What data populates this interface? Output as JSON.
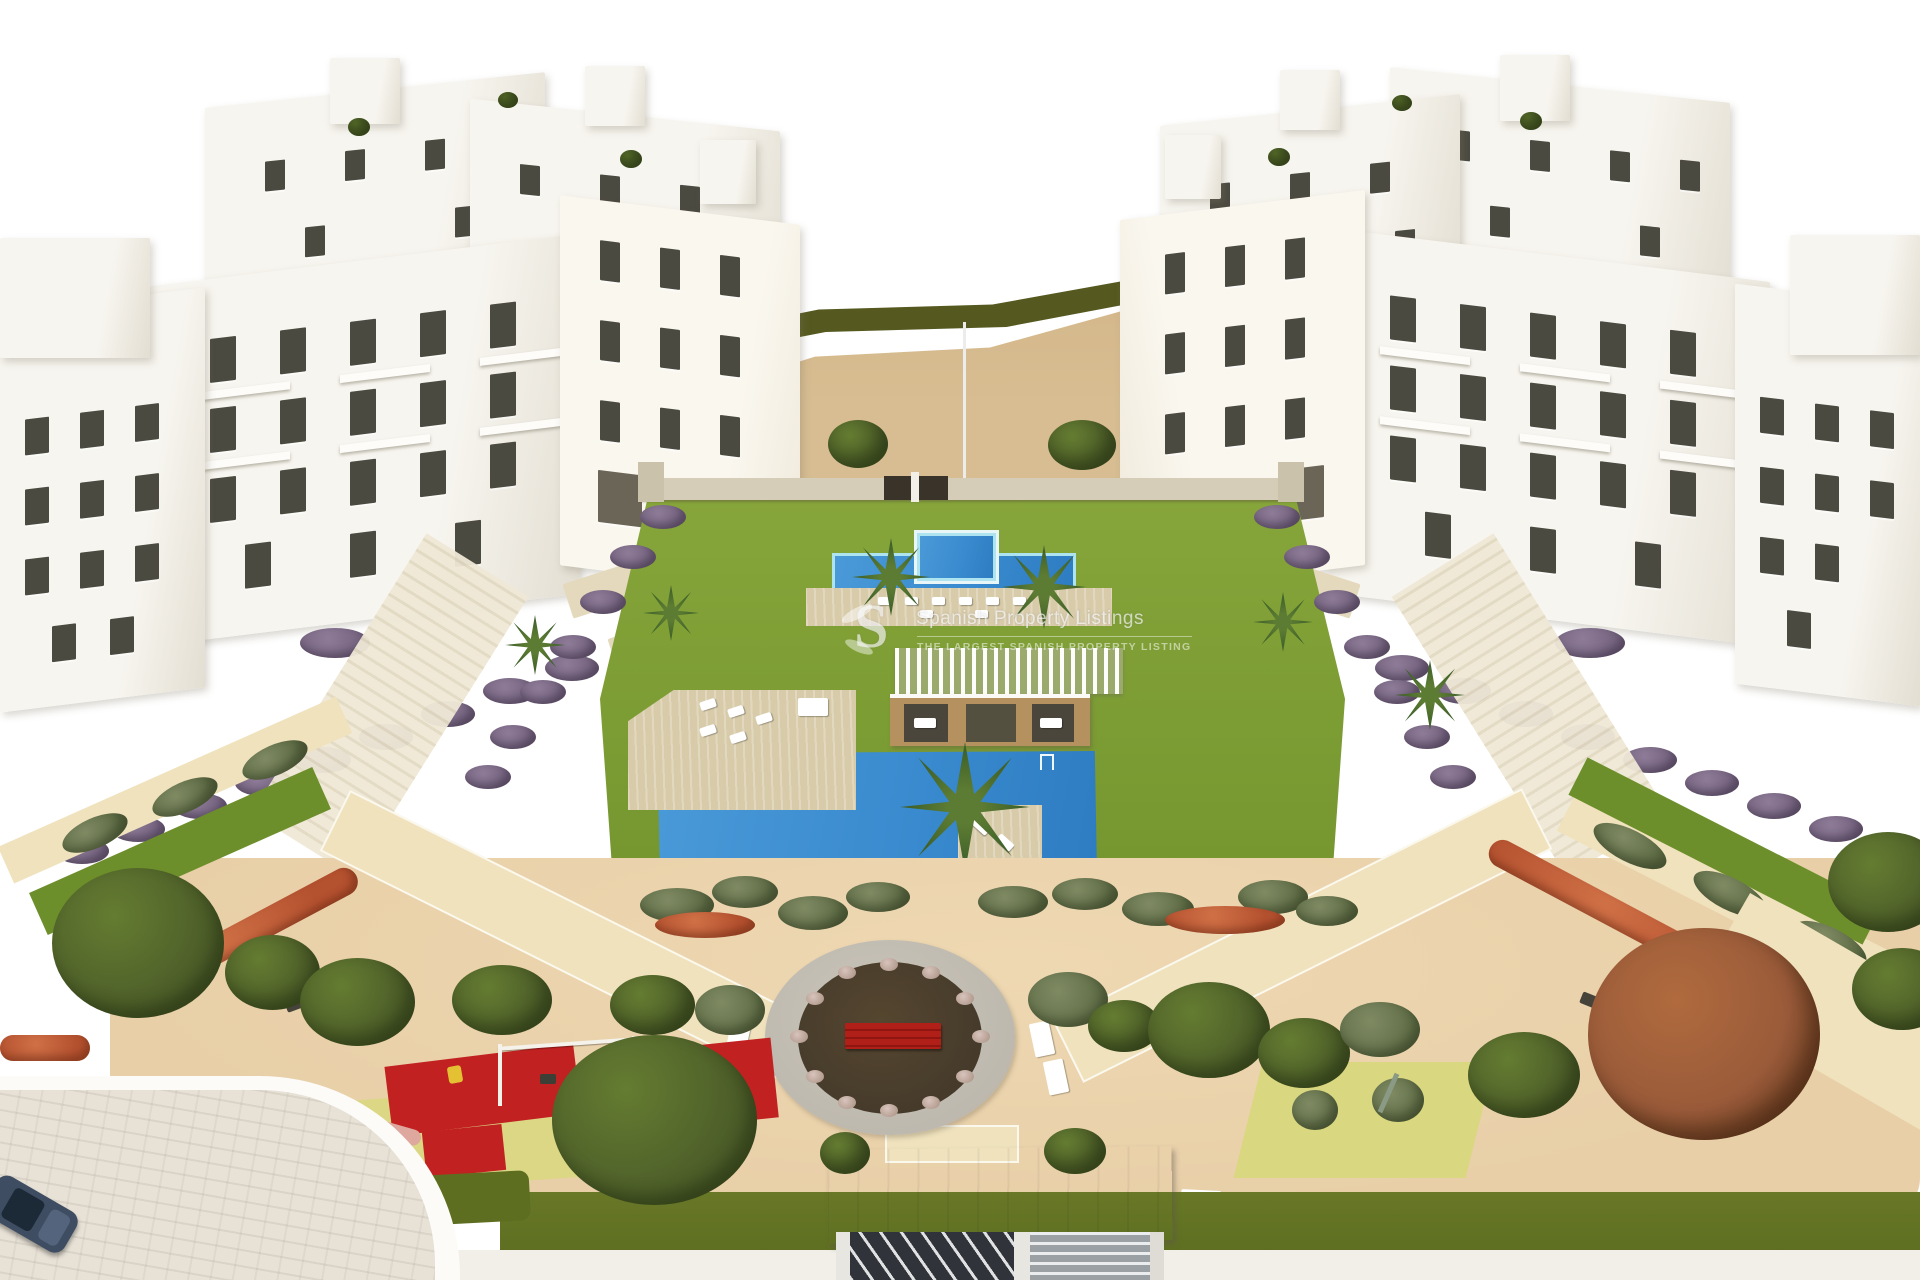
{
  "image": {
    "type": "architectural-render",
    "description": "Aerial 3D rendering of a white modern apartment complex with central communal gardens, three swimming pools, sun decks, a pergola pool-house, a circular plaza with red bench, two playgrounds, landscaped paths and an entrance gate"
  },
  "watermark": {
    "logo_letter": "S",
    "title": "Spanish Property Listings",
    "subtitle": "THE LARGEST SPANISH PROPERTY LISTING"
  },
  "palette": {
    "background": "#ffffff",
    "building_white": "#f7f5ef",
    "building_shade": "#e3ded2",
    "building_cream": "#efe9da",
    "window_dark": "#4b4a40",
    "terrace_beige": "#e4d9bd",
    "sand_hill": "#d8bd92",
    "hedge_olive": "#55591f",
    "lawn_green": "#7c9c34",
    "lawn_deep": "#6d8f2b",
    "pool_blue": "#3a8bcf",
    "pool_rim": "#aee4f0",
    "deck_beige": "#d8cbaa",
    "shrub_purple": "#75637f",
    "bush_gray": "#7f8a63",
    "tree_mid": "#647c31",
    "tree_dark": "#4a5a28",
    "flower_red": "#b4512f",
    "plaza_ring": "#bdb8ad",
    "plaza_soil": "#453a2b",
    "bench_red": "#b02018",
    "play_red": "#c12121",
    "play_yellow": "#d9d77f",
    "sand_fore": "#e8cfa8",
    "path_pale": "#efe2bd",
    "grass_band": "#5e6e21",
    "roof_gray": "#c9c7c2",
    "gate_dark": "#30343a",
    "car_navy": "#3e4d61",
    "white_paving": "#f2efe9",
    "autumn_red": "#9a5b3a"
  }
}
